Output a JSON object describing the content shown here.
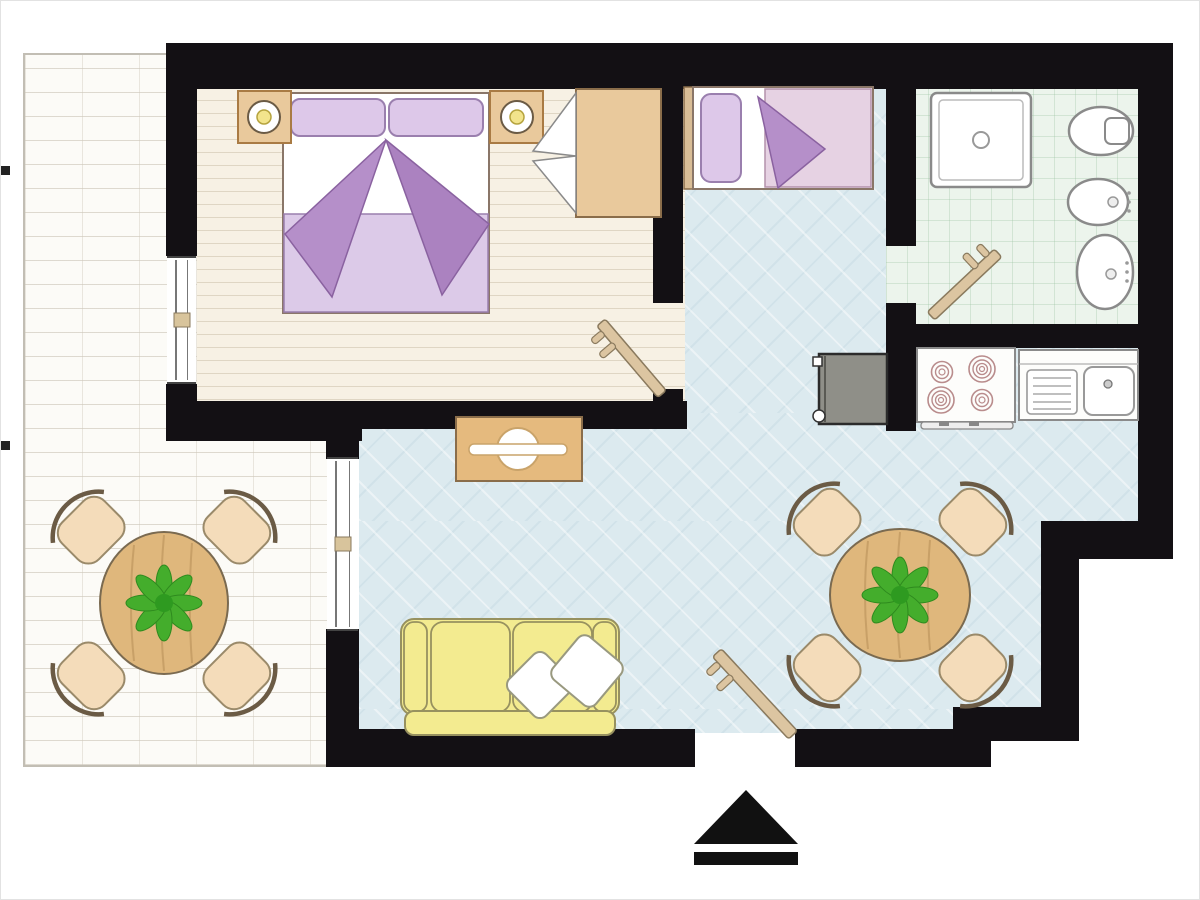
{
  "plan": {
    "kind": "apartment floor plan",
    "orientation_marker": "entrance-arrow",
    "text_labels": [],
    "rooms": [
      {
        "id": "terrace",
        "name": "terrace",
        "floor": "white brick paving",
        "furniture": [
          "round-dining-table",
          "four-chairs",
          "potted-plant"
        ]
      },
      {
        "id": "bedroom",
        "name": "double bedroom",
        "floor": "wood planks",
        "furniture": [
          "double-bed",
          "nightstand-left",
          "lamp-left",
          "nightstand-right",
          "lamp-right",
          "wardrobe",
          "swing-door"
        ]
      },
      {
        "id": "hall-living",
        "name": "living / dining area",
        "floor": "pale blue tile",
        "furniture": [
          "single-bed",
          "console-table",
          "sofa",
          "throw-pillows",
          "round-dining-table",
          "four-chairs",
          "potted-plant",
          "entrance-door"
        ]
      },
      {
        "id": "bathroom",
        "name": "bathroom",
        "floor": "mint tiles",
        "furniture": [
          "shower",
          "toilet",
          "bidet",
          "washbasin",
          "swing-door"
        ]
      },
      {
        "id": "kitchen",
        "name": "kitchen nook",
        "floor": "pale blue tile",
        "furniture": [
          "appliance-gray",
          "stove-4-burners",
          "counter-with-sink"
        ]
      }
    ]
  },
  "colors": {
    "wall": "#131014",
    "white": "#ffffff",
    "terrace_bg": "#fcfbf7",
    "bedroom_floor": "#f7f1e4",
    "blue_floor": "#dceaef",
    "bath_floor": "#ecf4ec",
    "lavender_light": "#ddc8e9",
    "lavender_blanket": "#dccae8",
    "pink_blanket": "#e6d2e3",
    "purple_fold": "#b58fc9",
    "purple_fold_dark": "#ab82c0",
    "wood": "#e9c99c",
    "wood_dark": "#dfb77c",
    "wood_console": "#e5ba7e",
    "door_plank": "#dcc5a1",
    "chair_peach": "#f4dcba",
    "sofa_yellow": "#f3eb90",
    "appliance_gray": "#8f8f88",
    "plant_green": "#44ad2c",
    "plant_green_dark": "#2e8a1e",
    "lamp_yellow": "#f2e48c",
    "fixture_stroke": "#8a8a8a",
    "burner_ring": "#b98c8c",
    "mullion_tan": "#d8c49c",
    "arrow_black": "#111111"
  }
}
